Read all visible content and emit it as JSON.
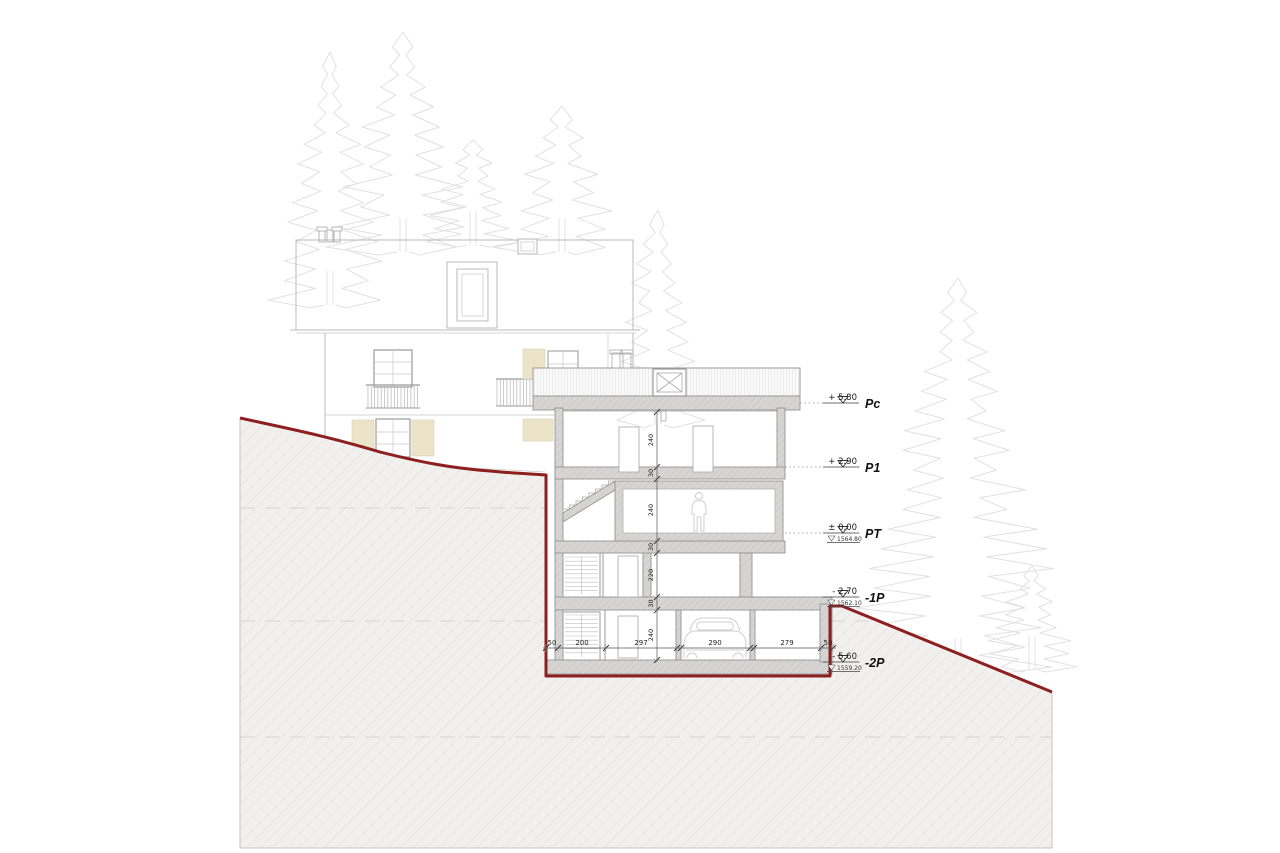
{
  "drawing": {
    "type": "architectural-cross-section",
    "levels": [
      {
        "label": "Pc",
        "value": "+ 5.80",
        "altitude": ""
      },
      {
        "label": "P1",
        "value": "+ 2.90",
        "altitude": ""
      },
      {
        "label": "PT",
        "value": "± 0.00",
        "altitude": "1564.80"
      },
      {
        "label": "-1P",
        "value": "- 2.70",
        "altitude": "1562.10"
      },
      {
        "label": "-2P",
        "value": "- 5.60",
        "altitude": "1559.20"
      }
    ],
    "dimensions": {
      "horizontal": [
        "50",
        "200",
        "297",
        "290",
        "279",
        "50"
      ],
      "vertical": [
        "240",
        "30",
        "240",
        "30",
        "220",
        "30",
        "240"
      ]
    },
    "colors": {
      "terrain_line": "#8e1f1f",
      "terrain_fill": "#f1f0ef",
      "wall_fill": "#d4d3d2",
      "tree_line": "#e1e1e1",
      "shutter_fill": "#ece4c9",
      "text": "#1a1a1a"
    },
    "scene": {
      "trees": [
        {
          "x": 330,
          "top": 52,
          "base": 305,
          "w": 55
        },
        {
          "x": 403,
          "top": 32,
          "base": 252,
          "w": 62
        },
        {
          "x": 473,
          "top": 140,
          "base": 245,
          "w": 45
        },
        {
          "x": 562,
          "top": 106,
          "base": 252,
          "w": 55
        },
        {
          "x": 658,
          "top": 210,
          "base": 425,
          "w": 48
        },
        {
          "x": 958,
          "top": 278,
          "base": 672,
          "w": 95
        },
        {
          "x": 1032,
          "top": 566,
          "base": 670,
          "w": 45
        }
      ]
    }
  }
}
